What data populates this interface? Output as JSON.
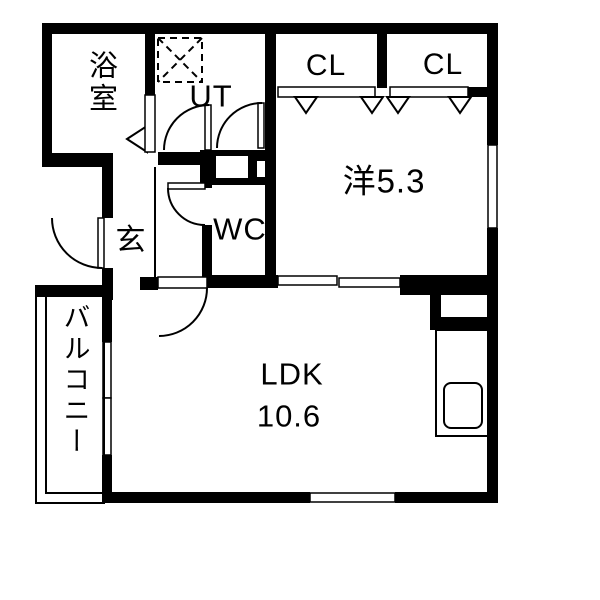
{
  "plan": {
    "title": "apartment-floor-plan",
    "rooms": {
      "bathroom": {
        "label": "浴室"
      },
      "utility": {
        "label": "UT"
      },
      "closet_left": {
        "label": "CL"
      },
      "closet_right": {
        "label": "CL"
      },
      "western_room": {
        "label": "洋5.3",
        "size_tatami": "5.3"
      },
      "wc": {
        "label": "WC"
      },
      "entrance": {
        "label": "玄"
      },
      "ldk": {
        "label": "LDK",
        "size": "10.6"
      },
      "balcony": {
        "label": "バルコニー"
      }
    },
    "colors": {
      "wall": "#000000",
      "background": "#ffffff",
      "text": "#000000"
    }
  }
}
